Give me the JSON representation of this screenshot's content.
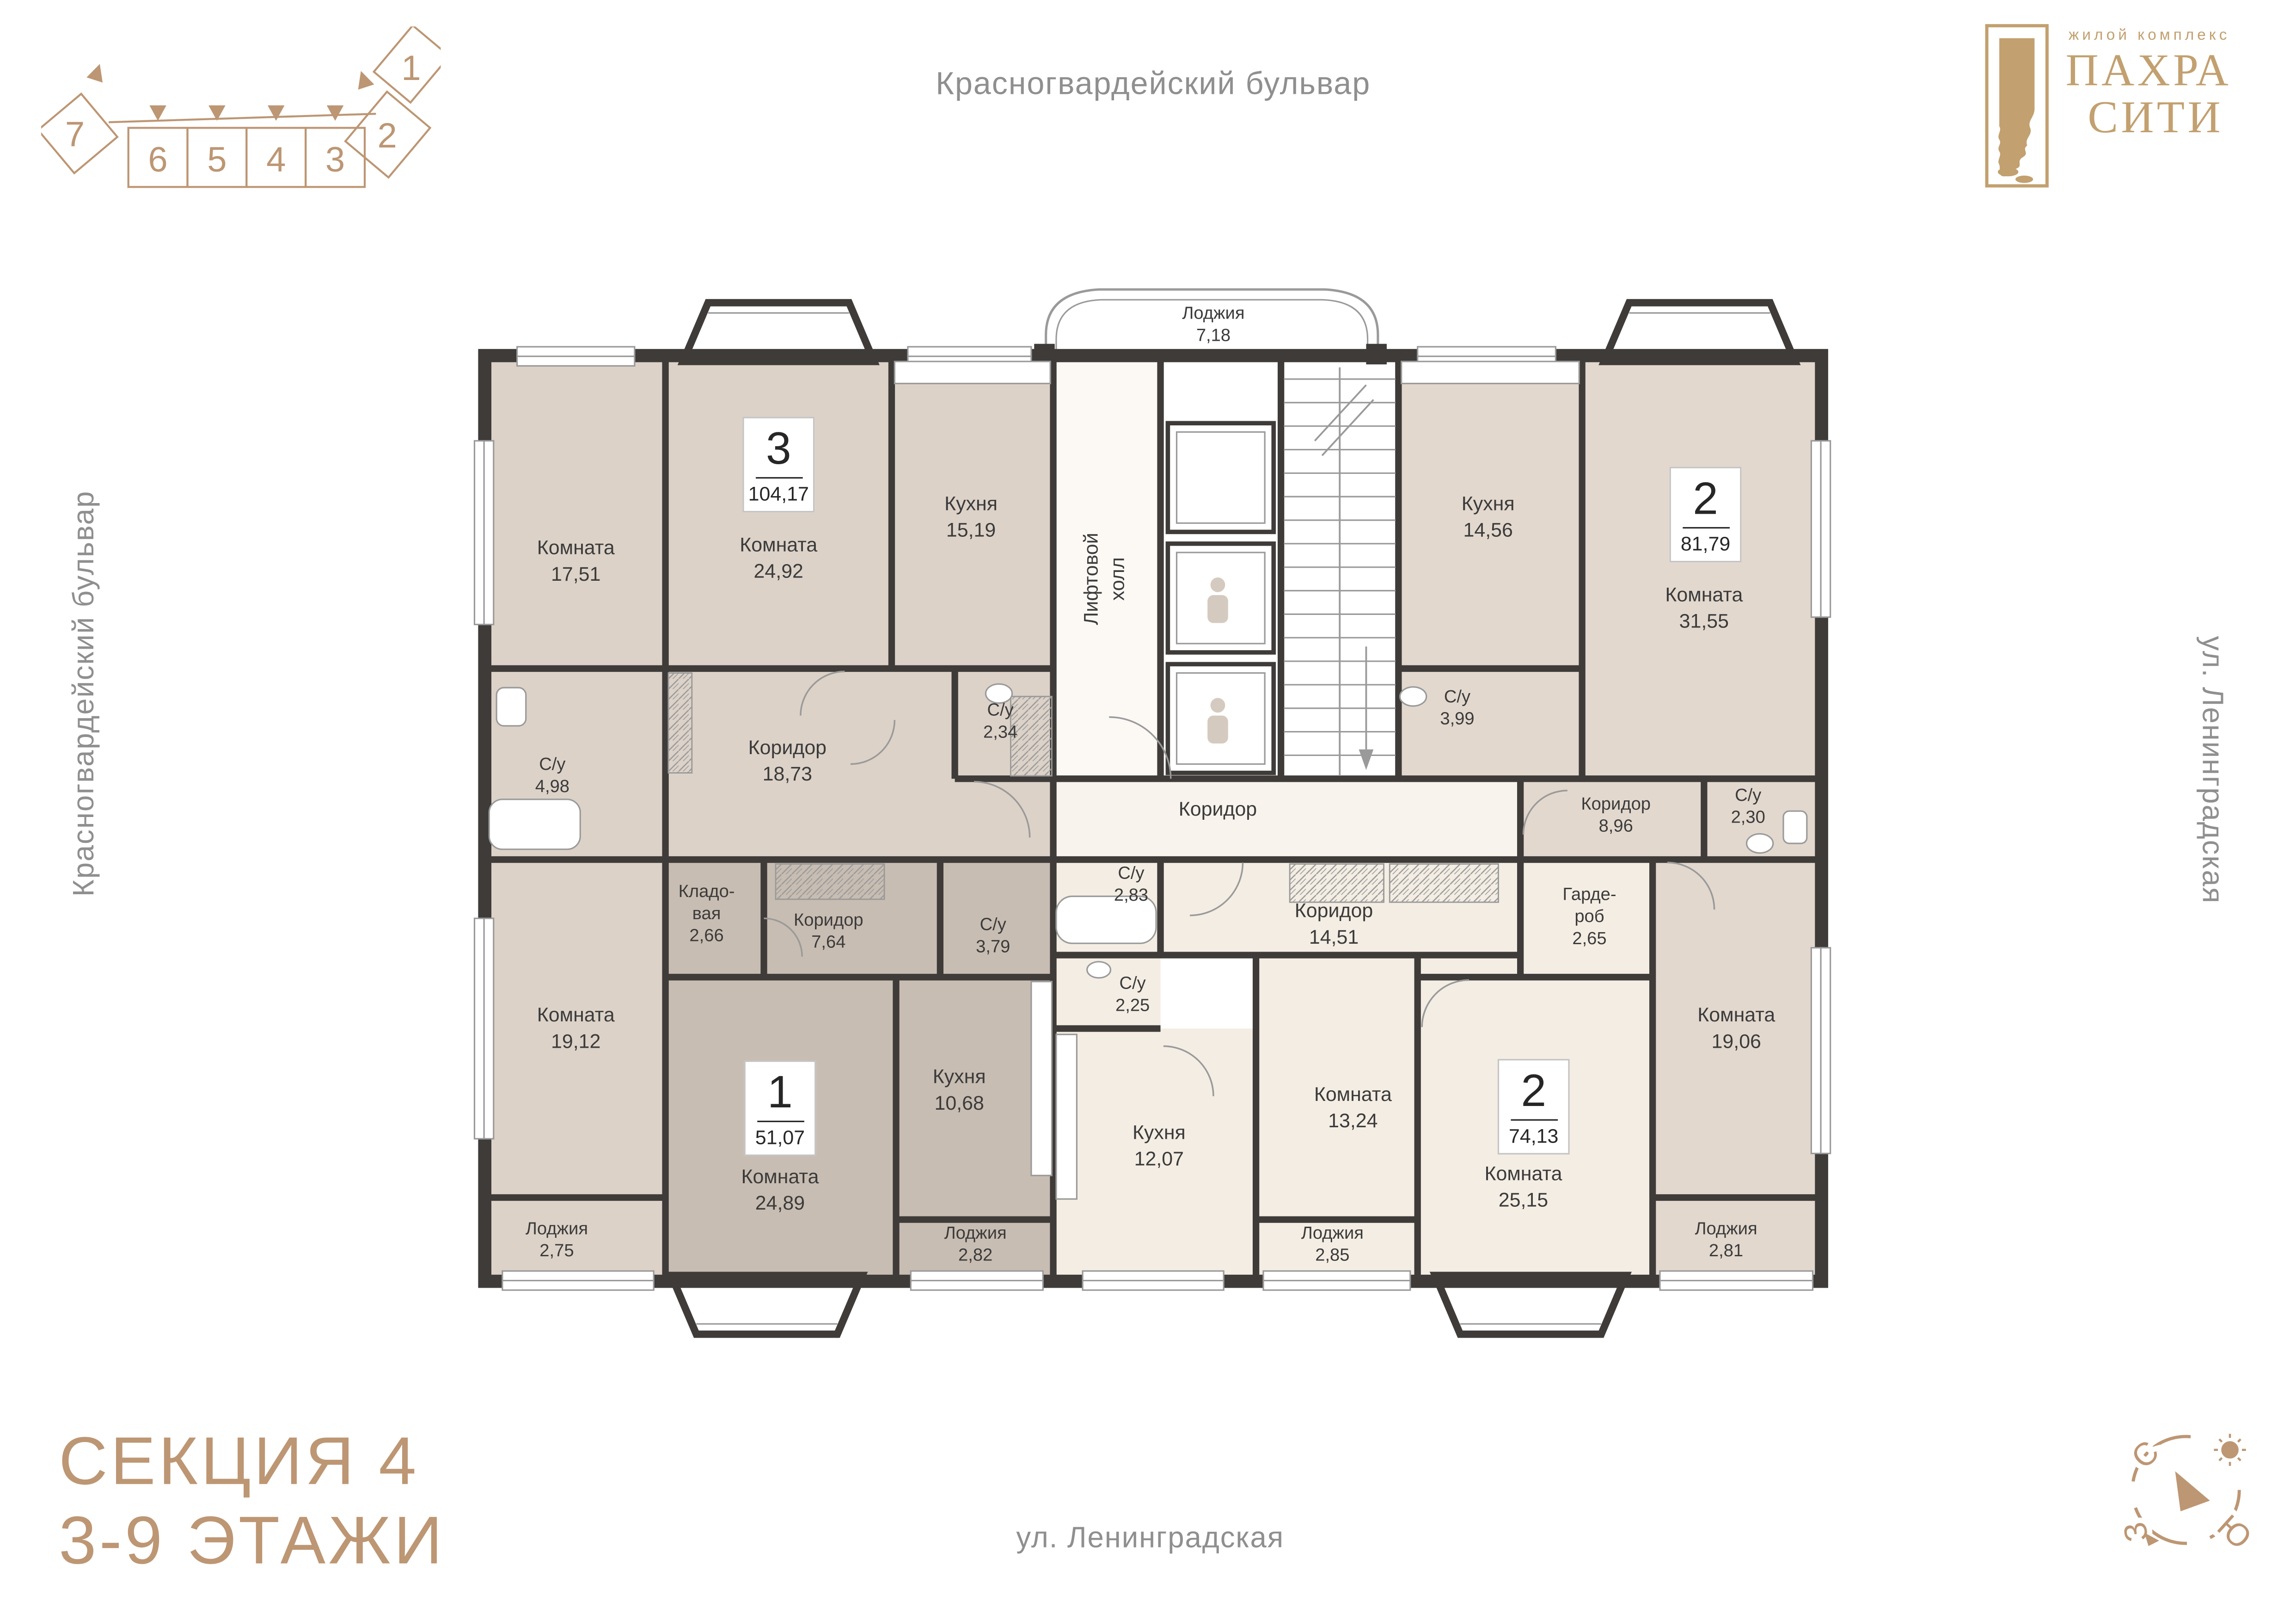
{
  "header": {
    "street_top": "Красногвардейский бульвар"
  },
  "logo": {
    "tagline": "жилой комплекс",
    "name_line1": "ПАХРА",
    "name_line2": "СИТИ"
  },
  "section_diagram": {
    "sections": [
      "1",
      "2",
      "3",
      "4",
      "5",
      "6",
      "7"
    ]
  },
  "sidebar_left": {
    "street": "Красногвардейский бульвар"
  },
  "sidebar_right": {
    "street": "ул. Ленинградская"
  },
  "footer": {
    "title_line1": "СЕКЦИЯ 4",
    "title_line2": "3-9 ЭТАЖИ",
    "street_bottom": "ул. Ленинградская"
  },
  "compass": {
    "north": "С",
    "west": "З",
    "south": "Ю"
  },
  "colors": {
    "accent": "#bd9673",
    "gold": "#c2a06f",
    "wall": "#3e3b39",
    "apt104": "#dcd2c8",
    "apt81": "#e2d8ce",
    "apt51": "#c8bdb2",
    "apt74": "#f4ede3",
    "hall": "#fcf9f5",
    "corridor": "#f8f3ec",
    "street": "#8f8f8f",
    "ink": "#3b3b3b",
    "line": "#9a9a9a"
  },
  "plan": {
    "apartments": [
      {
        "id": "apt_104",
        "rooms_count": "3",
        "area": "104,17"
      },
      {
        "id": "apt_81",
        "rooms_count": "2",
        "area": "81,79"
      },
      {
        "id": "apt_51",
        "rooms_count": "1",
        "area": "51,07"
      },
      {
        "id": "apt_74",
        "rooms_count": "2",
        "area": "74,13"
      }
    ],
    "rooms": [
      {
        "id": "room_17_51",
        "name": "Комната",
        "area": "17,51"
      },
      {
        "id": "room_24_92",
        "name": "Комната",
        "area": "24,92"
      },
      {
        "id": "kitchen_15_19",
        "name": "Кухня",
        "area": "15,19"
      },
      {
        "id": "su_4_98",
        "name": "С/у",
        "area": "4,98"
      },
      {
        "id": "corridor_18_73",
        "name": "Коридор",
        "area": "18,73"
      },
      {
        "id": "su_2_34",
        "name": "С/у",
        "area": "2,34"
      },
      {
        "id": "loggia_7_18",
        "name": "Лоджия",
        "area": "7,18"
      },
      {
        "id": "room_19_12",
        "name": "Комната",
        "area": "19,12"
      },
      {
        "id": "loggia_2_75",
        "name": "Лоджия",
        "area": "2,75"
      },
      {
        "id": "kitchen_14_56",
        "name": "Кухня",
        "area": "14,56"
      },
      {
        "id": "room_31_55",
        "name": "Комната",
        "area": "31,55"
      },
      {
        "id": "su_3_99",
        "name": "С/у",
        "area": "3,99"
      },
      {
        "id": "corridor_8_96",
        "name": "Коридор",
        "area": "8,96"
      },
      {
        "id": "su_2_30",
        "name": "С/у",
        "area": "2,30"
      },
      {
        "id": "room_19_06",
        "name": "Комната",
        "area": "19,06"
      },
      {
        "id": "loggia_2_81",
        "name": "Лоджия",
        "area": "2,81"
      },
      {
        "id": "storeroom_2_66",
        "name": "Кладо-\nвая",
        "area": "2,66"
      },
      {
        "id": "corridor_7_64",
        "name": "Коридор",
        "area": "7,64"
      },
      {
        "id": "su_3_79",
        "name": "С/у",
        "area": "3,79"
      },
      {
        "id": "room_24_89",
        "name": "Комната",
        "area": "24,89"
      },
      {
        "id": "kitchen_10_68",
        "name": "Кухня",
        "area": "10,68"
      },
      {
        "id": "loggia_2_82",
        "name": "Лоджия",
        "area": "2,82"
      },
      {
        "id": "su_2_83",
        "name": "С/у",
        "area": "2,83"
      },
      {
        "id": "su_2_25",
        "name": "С/у",
        "area": "2,25"
      },
      {
        "id": "kitchen_12_07",
        "name": "Кухня",
        "area": "12,07"
      },
      {
        "id": "room_13_24",
        "name": "Комната",
        "area": "13,24"
      },
      {
        "id": "loggia_2_85",
        "name": "Лоджия",
        "area": "2,85"
      },
      {
        "id": "corridor_14_51",
        "name": "Коридор",
        "area": "14,51"
      },
      {
        "id": "wardrobe_2_65",
        "name": "Гарде-\nроб",
        "area": "2,65"
      },
      {
        "id": "room_25_15",
        "name": "Комната",
        "area": "25,15"
      },
      {
        "id": "corridor_center",
        "name": "Коридор",
        "area": ""
      },
      {
        "id": "lift_hall",
        "name": "Лифтовой\nхолл",
        "area": ""
      }
    ]
  }
}
